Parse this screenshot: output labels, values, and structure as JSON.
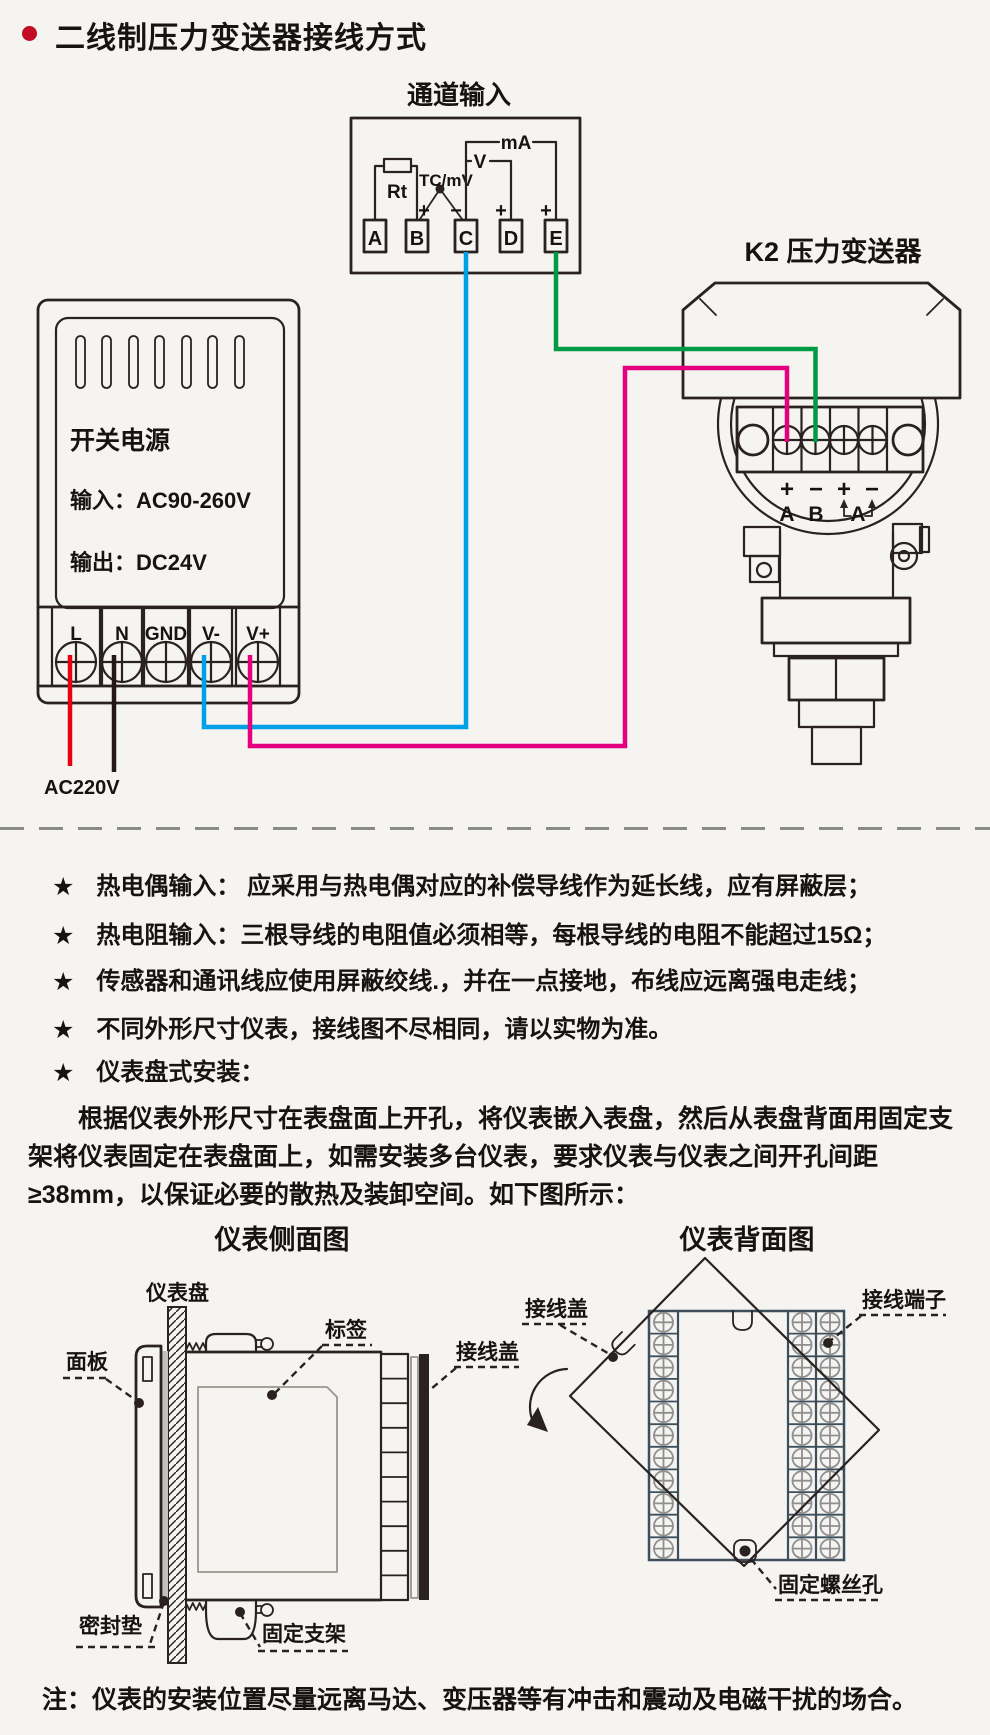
{
  "page": {
    "title": "二线制压力变送器接线方式",
    "note_marker": "★",
    "bottom_note": "注：仪表的安装位置尽量远离马达、变压器等有冲击和震动及电磁干扰的场合。"
  },
  "colors": {
    "bg": "#f5f4f1",
    "line": "#2a2220",
    "text": "#171310",
    "bullet": "#c30d23",
    "red": "#e60012",
    "black": "#231815",
    "cyan": "#00a0e9",
    "magenta": "#e4007f",
    "green": "#009a44",
    "slate": "#3d4f5d",
    "gray": "#8f8f8f",
    "lightline": "#9a948e",
    "gasket": "#c4c1bc"
  },
  "channel_input": {
    "title": "通道输入",
    "terminals": [
      "A",
      "B",
      "C",
      "D",
      "E"
    ],
    "rt_label": "Rt",
    "tc_label": "TC/mV",
    "v_label": "V",
    "ma_label": "mA",
    "plus": "+",
    "minus": "−"
  },
  "transmitter": {
    "title": "K2 压力变送器",
    "polarity": [
      "+",
      "−",
      "+",
      "−"
    ],
    "term_a": "A",
    "term_b": "B",
    "bracket_label": "A"
  },
  "power_supply": {
    "name": "开关电源",
    "input": "输入：AC90-260V",
    "output": "输出：DC24V",
    "terminals": [
      "L",
      "N",
      "GND",
      "V-",
      "V+"
    ],
    "mains_label": "AC220V"
  },
  "notes": [
    "热电偶输入： 应采用与热电偶对应的补偿导线作为延长线，应有屏蔽层；",
    "热电阻输入：三根导线的电阻值必须相等，每根导线的电阻不能超过15Ω；",
    "传感器和通讯线应使用屏蔽绞线.，并在一点接地，布线应远离强电走线；",
    "不同外形尺寸仪表，接线图不尽相同，请以实物为准。",
    "仪表盘式安装："
  ],
  "install_paragraph": "根据仪表外形尺寸在表盘面上开孔，将仪表嵌入表盘，然后从表盘背面用固定支架将仪表固定在表盘面上，如需安装多台仪表，要求仪表与仪表之间开孔间距≥38mm，以保证必要的散热及装卸空间。如下图所示：",
  "side_view": {
    "title": "仪表侧面图",
    "labels": {
      "panel_board": "仪表盘",
      "front_panel": "面板",
      "tag": "标签",
      "terminal_cover": "接线盖",
      "gasket": "密封垫",
      "bracket": "固定支架"
    }
  },
  "back_view": {
    "title": "仪表背面图",
    "labels": {
      "terminal_cover": "接线盖",
      "terminal_block": "接线端子",
      "screw_hole": "固定螺丝孔"
    }
  }
}
